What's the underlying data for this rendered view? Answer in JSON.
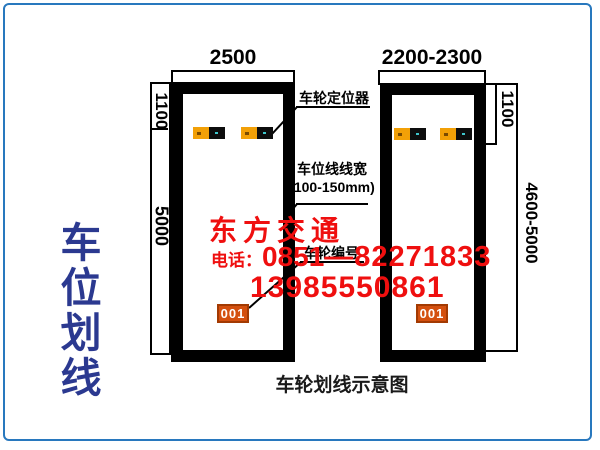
{
  "side_title": {
    "text": "车位划线"
  },
  "caption": "车轮划线示意图",
  "diagram": {
    "left_space": {
      "width_label": "2500",
      "top_offset_label": "1100",
      "length_label": "5000",
      "badge": "001"
    },
    "right_space": {
      "width_label": "2200-2300",
      "top_offset_label": "1100",
      "length_label": "4600-5000",
      "badge": "001"
    },
    "annotations": {
      "wheel_positioner": "车轮定位器",
      "line_width_line1": "车位线线宽",
      "line_width_line2": "(100-150mm)",
      "wheel_number": "车轮编号"
    }
  },
  "watermark": {
    "brand": "东方交通",
    "phone_label": "电话：",
    "phone_part1": "0851",
    "phone_part2": "—82271833",
    "phone_alt": "13985550861"
  },
  "colors": {
    "frame_blue": "#2878BE",
    "title_blue": "#2B3990",
    "watermark_red": "#EF0F0F",
    "badge_orange": "#D4500F",
    "positioner_orange": "#F2A007",
    "line_black": "#000000"
  }
}
